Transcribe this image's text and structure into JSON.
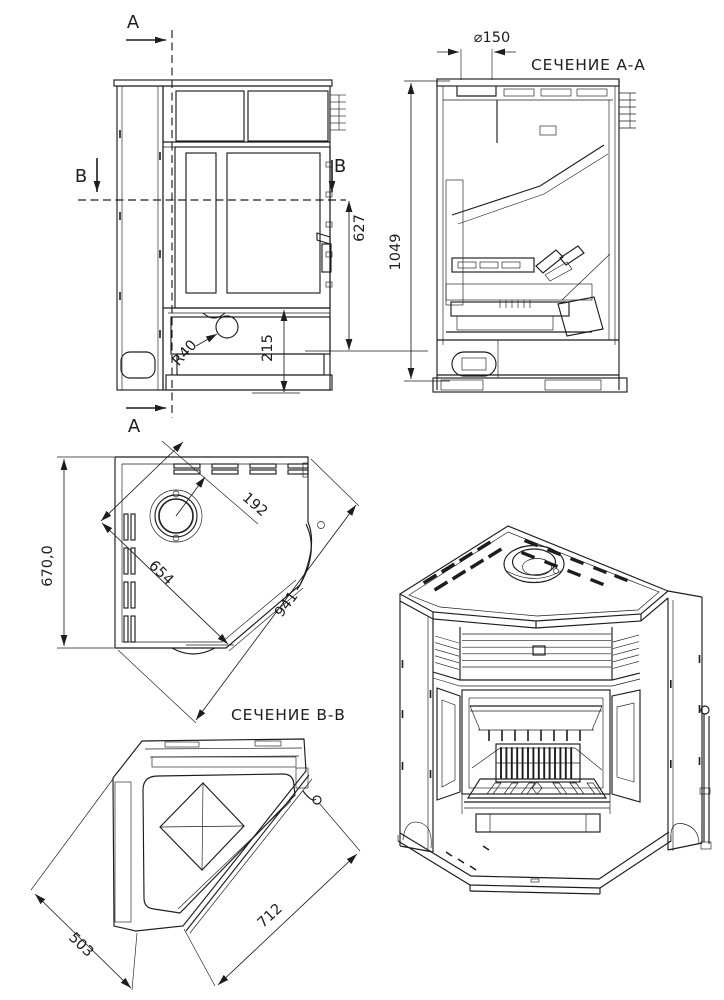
{
  "drawing": {
    "bg": "#ffffff",
    "ink": "#1d1d1d",
    "views": {
      "front": {
        "section_a_top": "А",
        "section_a_bottom": "А",
        "section_b_left": "В",
        "section_b_right": "В",
        "dim_627": "627",
        "dim_215": "215",
        "dim_r40": "R40"
      },
      "section_aa": {
        "title": "СЕЧЕНИЕ А-А",
        "dim_flue": "⌀150",
        "dim_1049": "1049"
      },
      "plan": {
        "dim_670": "670,0",
        "dim_192": "192",
        "dim_654": "654",
        "dim_941": "941"
      },
      "section_bb": {
        "title": "СЕЧЕНИЕ В-В",
        "dim_503": "503",
        "dim_712": "712"
      }
    }
  }
}
